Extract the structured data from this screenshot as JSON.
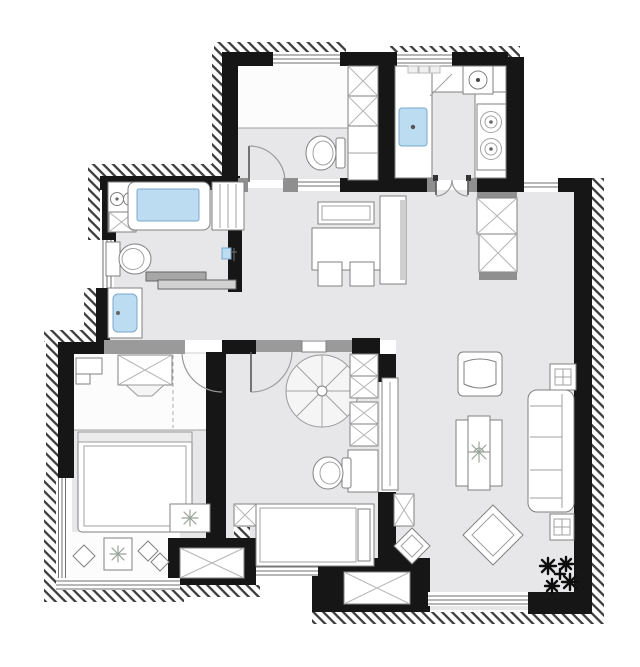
{
  "meta": {
    "title": "apartment-floor-plan",
    "canvas": {
      "width": 640,
      "height": 667
    }
  },
  "palette": {
    "wall": "#161616",
    "floor": "#e7e7e9",
    "water": "#bcdcf2",
    "water_stroke": "#79a9cc",
    "furniture_stroke": "#818181",
    "trim_gray": "#8f8f8f",
    "header_gray": "#9a9a9a",
    "arc_gray": "#9a9a9a",
    "plant_dark": "#0d0d0d",
    "plant_light": "#99a399",
    "bg": "#ffffff"
  },
  "rooms": [
    {
      "id": "bathroom",
      "fixtures": [
        "laundry-counter",
        "washing-machine",
        "bathtub",
        "storage-cabinet",
        "toilet",
        "shower-mixer",
        "sliding-door",
        "washbasin-vanity",
        "window"
      ]
    },
    {
      "id": "small-room",
      "fixtures": [
        "platform-bed",
        "wardrobe",
        "toilet",
        "swing-door",
        "window",
        "pass-through"
      ]
    },
    {
      "id": "kitchen",
      "l-counter": true,
      "fixtures": [
        "kitchen-sink",
        "round-basin",
        "gas-stove",
        "french-doors",
        "window"
      ]
    },
    {
      "id": "entry-hall",
      "fixtures": [
        "shoe-cabinet",
        "shoe-cabinet",
        "threshold"
      ]
    },
    {
      "id": "dining-area",
      "fixtures": [
        "sideboard",
        "dining-table",
        "dining-chair",
        "dining-chair",
        "tall-cabinet"
      ]
    },
    {
      "id": "bedroom",
      "fixtures": [
        "closet-header",
        "wardrobe",
        "desk",
        "double-bed",
        "rug-with-plant",
        "bay-window-seat",
        "pillows",
        "swing-door",
        "window"
      ]
    },
    {
      "id": "multi-room",
      "fixtures": [
        "spiral-staircase",
        "wardrobe-column",
        "vanity",
        "toilet",
        "single-bed",
        "nightstand",
        "swing-door",
        "bay-window",
        "glass-panel"
      ]
    },
    {
      "id": "living-room",
      "fixtures": [
        "armchair",
        "side-table",
        "sofa",
        "coffee-table",
        "floor-cushion",
        "floor-cushion",
        "side-table",
        "plant",
        "storage-box",
        "window",
        "bay-window"
      ]
    }
  ],
  "icons": {
    "hatch-band": "masonry exterior wall hatching",
    "x-box": "cabinet / fixed-window cross symbol",
    "door-arc": "door swing arc"
  }
}
